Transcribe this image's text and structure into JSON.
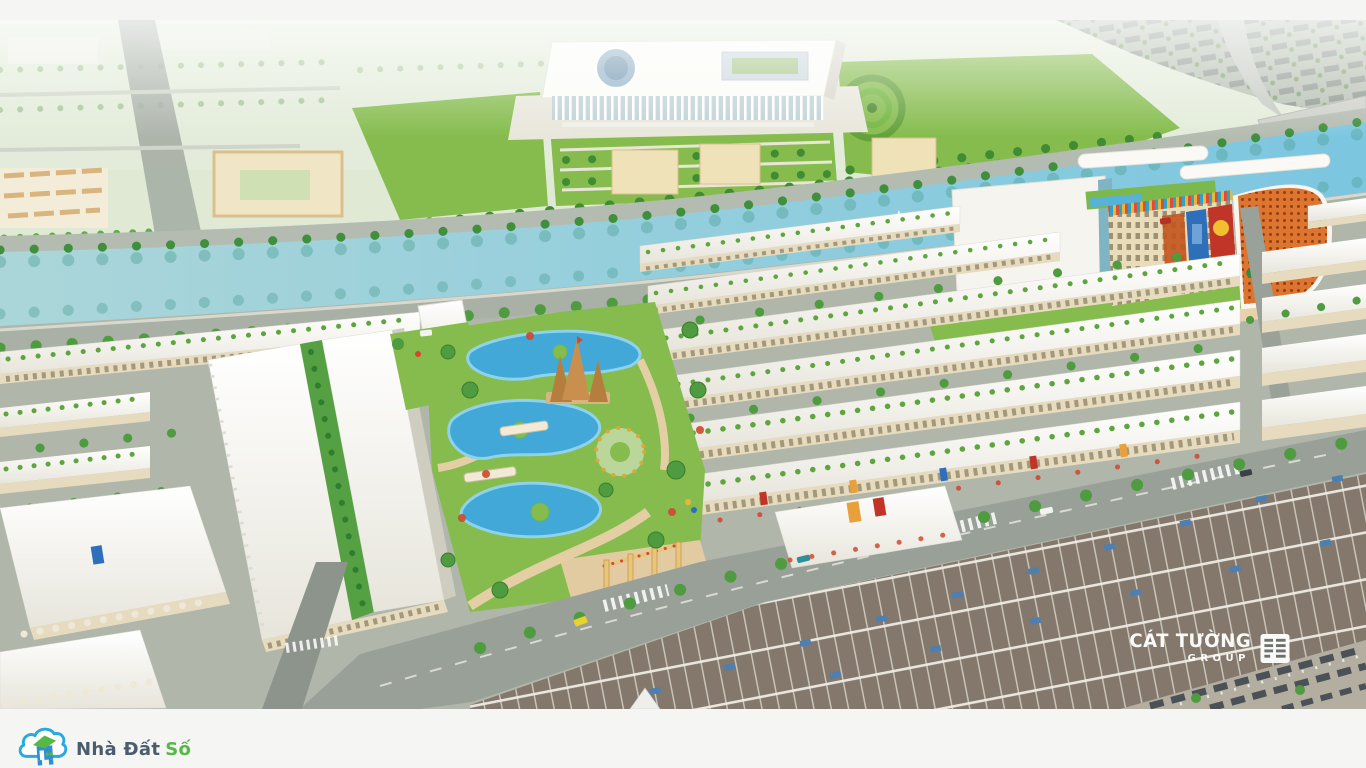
{
  "meta": {
    "description": "Aerial 3D architectural rendering of a township master plan: river canal with palm-lined boulevard, grand colonnade hall and formal gardens, shopping mall with orange lattice facade, rows of white townhouses, central lagoon theme park and plotted roof rows",
    "image_width": 1366,
    "image_height": 768
  },
  "watermark": {
    "brand": "CÁT TƯỜNG",
    "sub": "GROUP",
    "icon": "building-grid-icon"
  },
  "footer_logo": {
    "name_primary": "Nhà Đất",
    "name_accent": "Số",
    "icon": "cloud-house-logo-icon"
  },
  "colors": {
    "page_bg": "#f5f5f4",
    "wm_color": "#ffffff",
    "logo_cloud": "#2aa9df",
    "logo_house": "#2f8fd0",
    "logo_green": "#56b847",
    "logo_slate": "#4a5d6e",
    "lawn": "#85bc4d",
    "water": "#a7d4d9",
    "water_deep": "#7cc6e0",
    "lagoon": "#41a8d8",
    "mall_orange": "#dd7430",
    "roof_white": "#f8f7f2",
    "facade_cream": "#e6dbbf",
    "road": "#9aa198",
    "plot_brown": "#83786b",
    "plot_blue": "#4f7fae",
    "path_pink": "#e7cba4",
    "castle_sand": "#c98f4e"
  }
}
